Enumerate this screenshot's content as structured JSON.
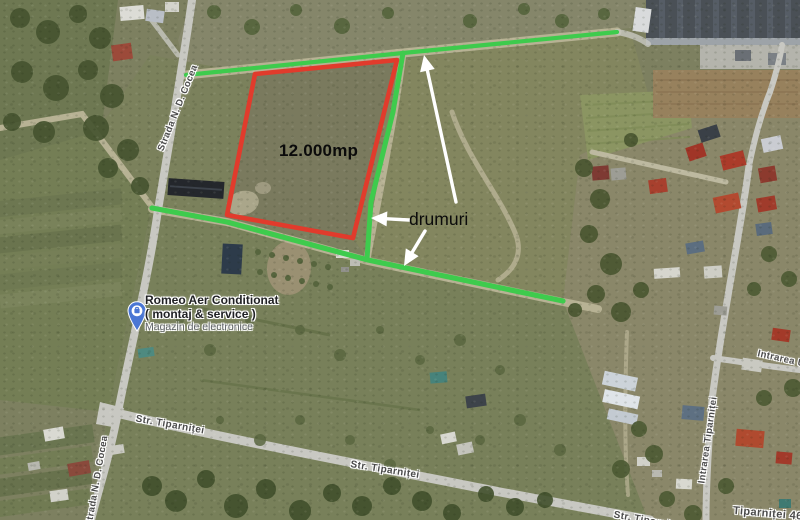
{
  "map": {
    "annotations": {
      "parcel": {
        "label": "12.000mp",
        "polygon": [
          [
            255,
            74
          ],
          [
            397,
            60
          ],
          [
            353,
            238
          ],
          [
            227,
            215
          ]
        ]
      },
      "roads_note": {
        "label": "drumuri"
      },
      "green_roads": [
        {
          "points": [
            [
              186,
              75
            ],
            [
              403,
              53
            ],
            [
              617,
              32
            ]
          ],
          "width": 4.2
        },
        {
          "points": [
            [
              403,
              53
            ],
            [
              393,
              112
            ],
            [
              371,
              202
            ],
            [
              367,
              259
            ]
          ],
          "width": 5
        },
        {
          "points": [
            [
              152,
              208
            ],
            [
              227,
              222
            ],
            [
              368,
              260
            ],
            [
              563,
              301
            ]
          ],
          "width": 5.2
        }
      ],
      "arrows": [
        {
          "tail": [
            456,
            202
          ],
          "tip": [
            424,
            55
          ]
        },
        {
          "tail": [
            409,
            220
          ],
          "tip": [
            371,
            218
          ]
        },
        {
          "tail": [
            425,
            231
          ],
          "tip": [
            404,
            266
          ]
        }
      ]
    },
    "business": {
      "name": "Romeo Aer Conditionat",
      "subtitle": "( montaj & service )",
      "category": "Magazin de electronice"
    },
    "street_labels": [
      {
        "id": "strada-n-d-cocea-upper",
        "text": "Strada N. D. Cocea",
        "x": 178,
        "y": 108,
        "angle": -68,
        "size": 9.5
      },
      {
        "id": "strada-n-d-cocea-lower",
        "text": "Strada N. D. Cocea",
        "x": 97,
        "y": 481,
        "angle": -80,
        "size": 9.5
      },
      {
        "id": "str-tiparnitei-west",
        "text": "Str. Tiparniței",
        "x": 170,
        "y": 425,
        "angle": 10,
        "size": 10
      },
      {
        "id": "str-tiparnitei-east",
        "text": "Str. Tiparniței",
        "x": 385,
        "y": 470,
        "angle": 9,
        "size": 10
      },
      {
        "id": "str-tiparnitei-clipped",
        "text": "Str. Tiparniței",
        "x": 648,
        "y": 521,
        "angle": 10,
        "size": 10
      },
      {
        "id": "intrarea-tiparnitei",
        "text": "Intrarea Tiparniței",
        "x": 708,
        "y": 440,
        "angle": -82,
        "size": 9.5
      },
      {
        "id": "intrarea-ura",
        "text": "Intrarea Ura",
        "x": 786,
        "y": 360,
        "angle": 13,
        "size": 9.5
      },
      {
        "id": "tiparnitei-46a",
        "text": "Tiparniței 46A",
        "x": 772,
        "y": 514,
        "angle": 5,
        "size": 11
      }
    ],
    "colors": {
      "parcel_outline": "#e13b2c",
      "green_road": "#3ecb4d",
      "arrow": "#ffffff",
      "pin_blue": "#4a76d4",
      "business_name": "#202124",
      "business_category": "#5f6368",
      "street_label": "#4b4b4b",
      "annotation_text": "#0b0b0b"
    }
  }
}
